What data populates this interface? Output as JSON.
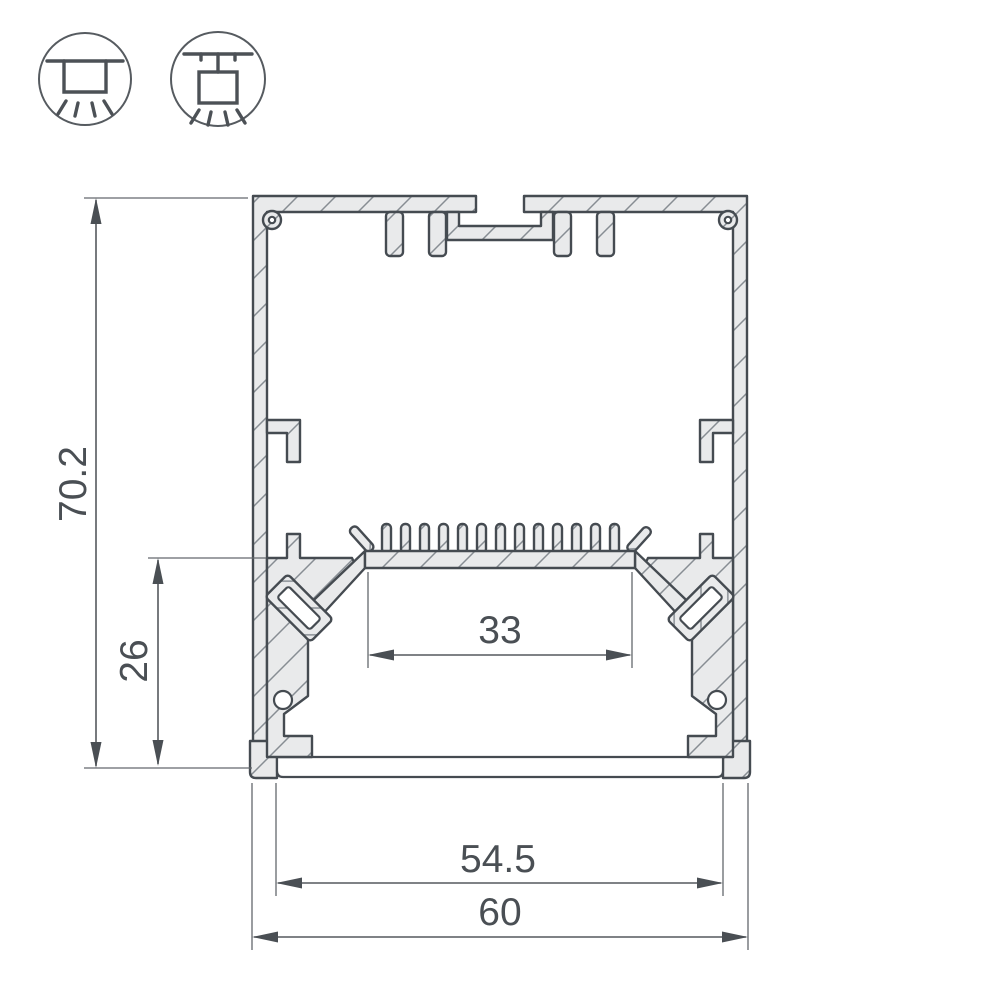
{
  "title": "LED profile cross-section technical drawing",
  "dims": {
    "overall_height": "70.2",
    "mount_depth": "26",
    "led_platform_width": "33",
    "inner_width": "54.5",
    "overall_width": "60"
  },
  "icons": [
    {
      "name": "surface-mount-icon"
    },
    {
      "name": "pendant-mount-icon"
    }
  ],
  "colors": {
    "outline": "#454b51",
    "metal_fill": "#e9eaeb",
    "hatch_line": "#878d93",
    "dimension_line": "#55595e",
    "text": "#4a4f54",
    "background": "#ffffff"
  }
}
